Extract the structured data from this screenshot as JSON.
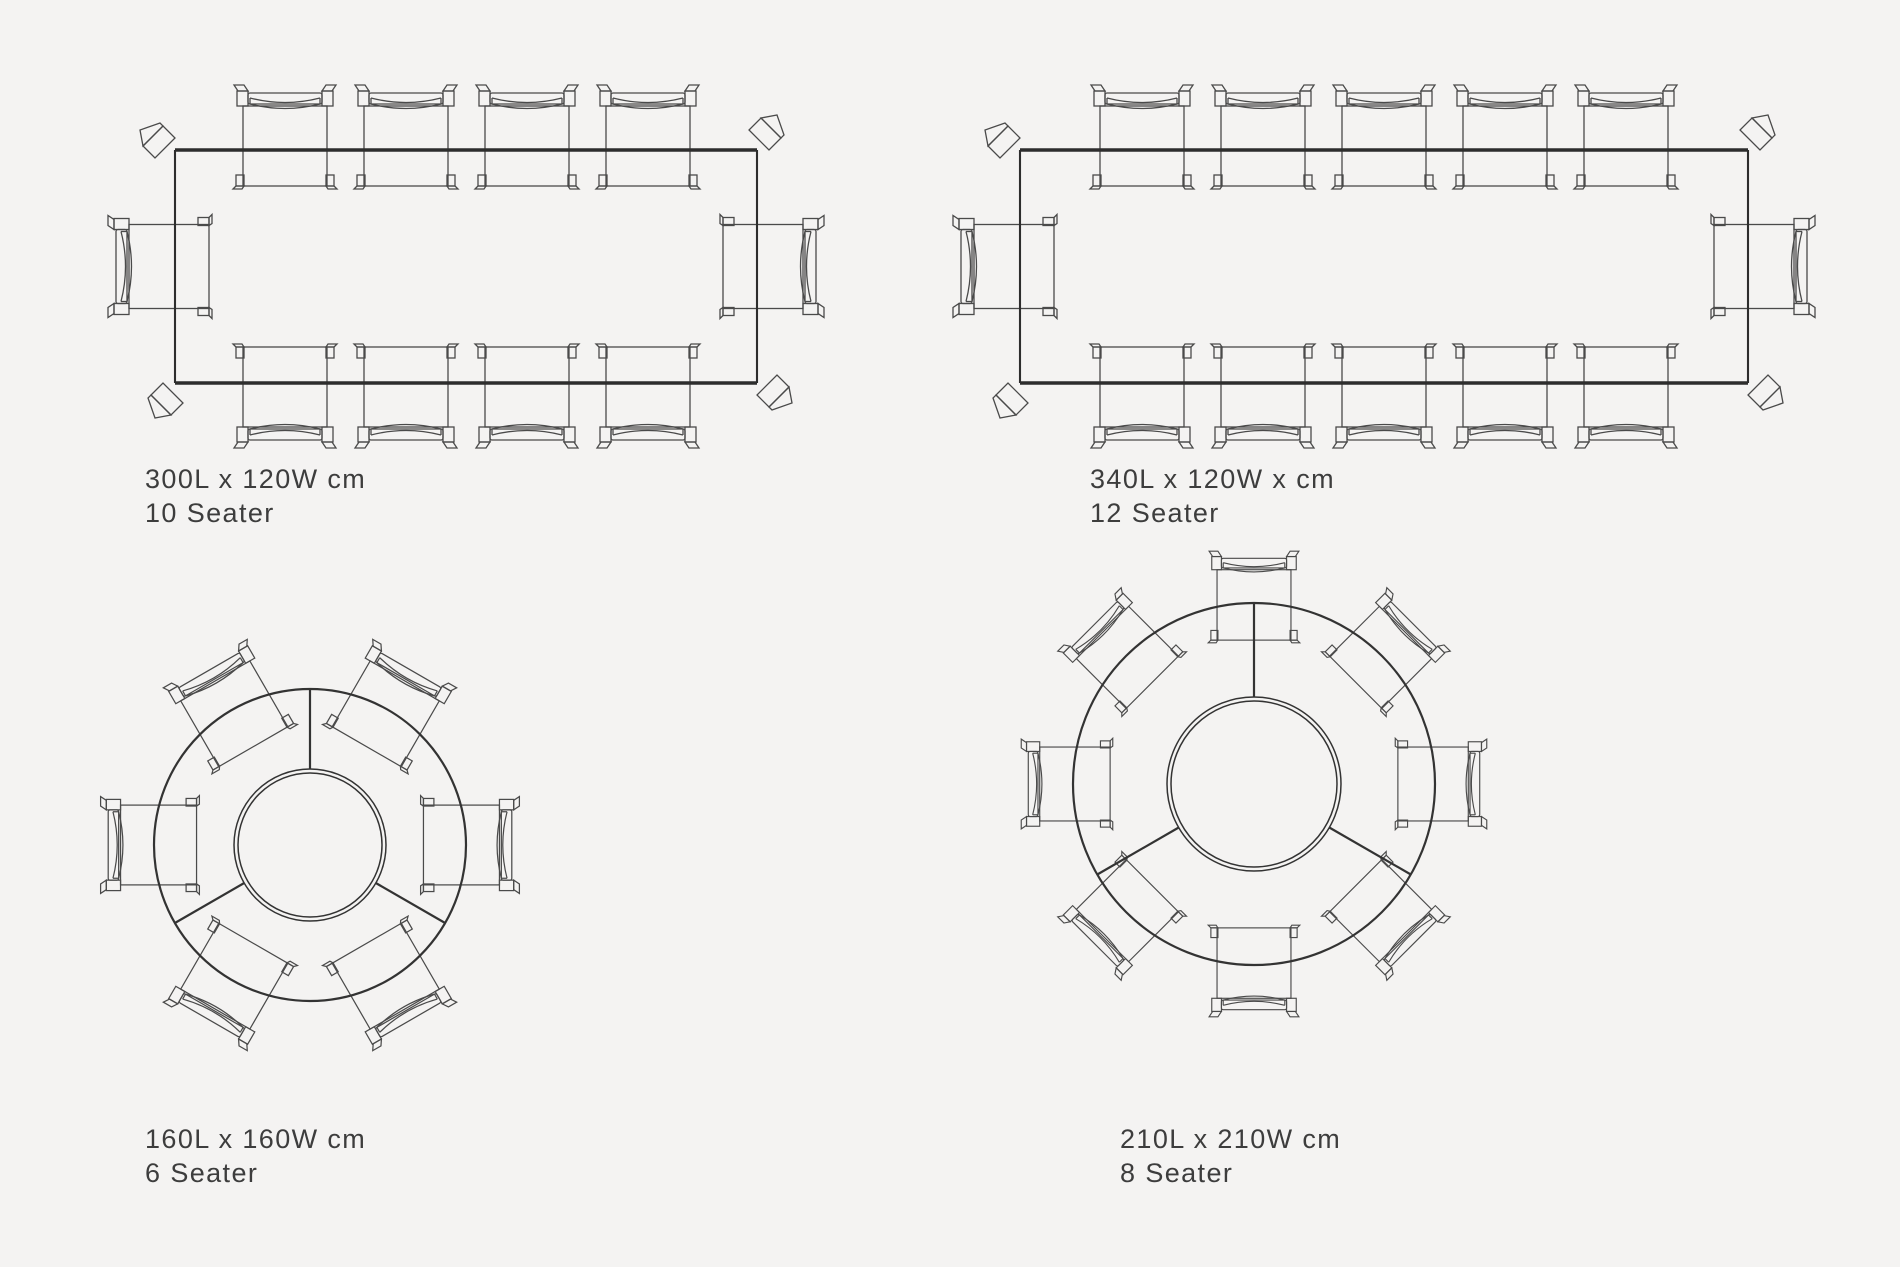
{
  "theme": {
    "bg": "#f4f3f2",
    "line": "#4a4a4a",
    "line-strong": "#2d2d2d",
    "text": "#3d3d3d"
  },
  "layouts": [
    {
      "name": "rectangular-dining-table-300",
      "shape": "rectangular",
      "dimensions": "300L x 120W cm",
      "seater": "10 Seater",
      "seats": 10,
      "chairs": {
        "long_side_top": 4,
        "long_side_bottom": 4,
        "end_left": 1,
        "end_right": 1
      }
    },
    {
      "name": "rectangular-dining-table-340",
      "shape": "rectangular",
      "dimensions": "340L x 120W x cm",
      "seater": "12 Seater",
      "seats": 12,
      "chairs": {
        "long_side_top": 5,
        "long_side_bottom": 5,
        "end_left": 1,
        "end_right": 1
      }
    },
    {
      "name": "round-dining-table-160",
      "shape": "round",
      "dimensions": "160L x 160W cm",
      "seater": "6 Seater",
      "seats": 6,
      "chairs": {
        "around": 6
      },
      "features": [
        "lazy-susan-centre",
        "three-segment-top"
      ]
    },
    {
      "name": "round-dining-table-210",
      "shape": "round",
      "dimensions": "210L x 210W cm",
      "seater": "8 Seater",
      "seats": 8,
      "chairs": {
        "around": 8
      },
      "features": [
        "lazy-susan-centre",
        "three-segment-top"
      ]
    }
  ]
}
